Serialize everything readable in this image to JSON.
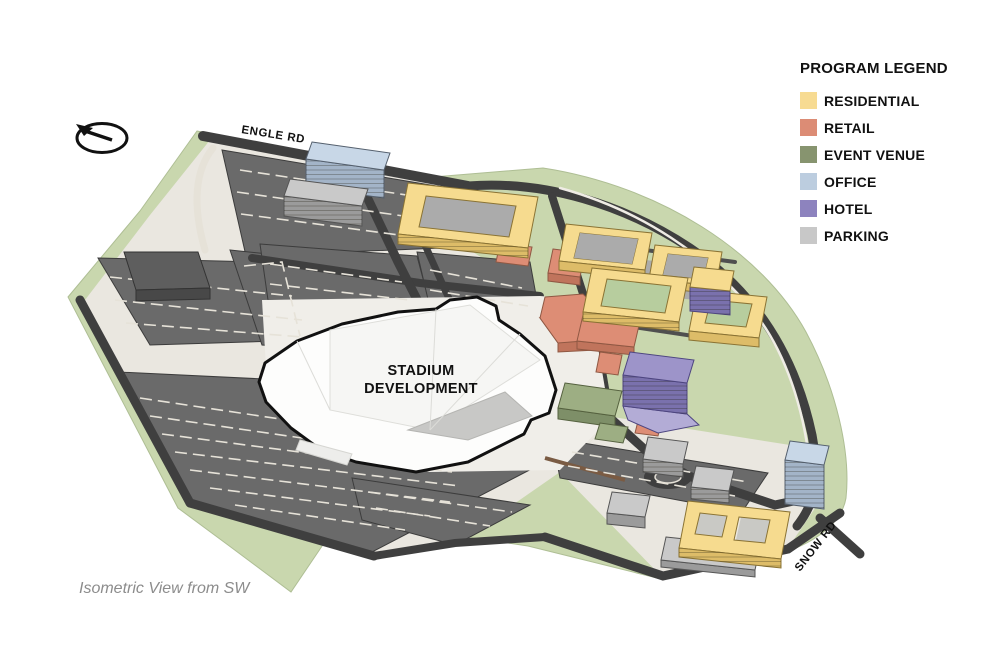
{
  "view_caption": "Isometric View from SW",
  "labels": {
    "stadium_line1": "STADIUM",
    "stadium_line2": "DEVELOPMENT",
    "road_top": "ENGLE RD",
    "road_bottom_right": "SNOW RD"
  },
  "legend": {
    "title": "PROGRAM LEGEND",
    "items": [
      {
        "label": "RESIDENTIAL",
        "color": "#F7DB92"
      },
      {
        "label": "RETAIL",
        "color": "#DC8C75"
      },
      {
        "label": "EVENT VENUE",
        "color": "#87946F"
      },
      {
        "label": "OFFICE",
        "color": "#BCCDDF"
      },
      {
        "label": "HOTEL",
        "color": "#8D83BE"
      },
      {
        "label": "PARKING",
        "color": "#C8C8C8"
      }
    ]
  },
  "icons": {
    "north_arrow": "north-arrow"
  },
  "colors": {
    "landscape": "#C9D7AE",
    "pavement": "#EAE7E0",
    "lot": "#6A6A6A",
    "road": "#3F3F3F",
    "stripe": "#E6E2D8",
    "stadium": "#FDFDFC",
    "stadium_outline": "#111111",
    "residential_top": "#F6DB8F",
    "residential_side": "#DDBC68",
    "retail_top": "#DD8D75",
    "retail_side": "#C0745C",
    "venue_top": "#9DAE83",
    "venue_side": "#7E8F68",
    "office_top": "#C8D7E7",
    "office_side": "#A3B4C8",
    "hotel_top": "#9D94C9",
    "hotel_side": "#7A71AD",
    "parking_top": "#C9C9C9",
    "parking_side": "#9B9B9B",
    "courtyard_green": "#B7CD9E",
    "courtyard_gray": "#ABABAB",
    "existing_top": "#5E5E5E",
    "existing_side": "#484848"
  }
}
